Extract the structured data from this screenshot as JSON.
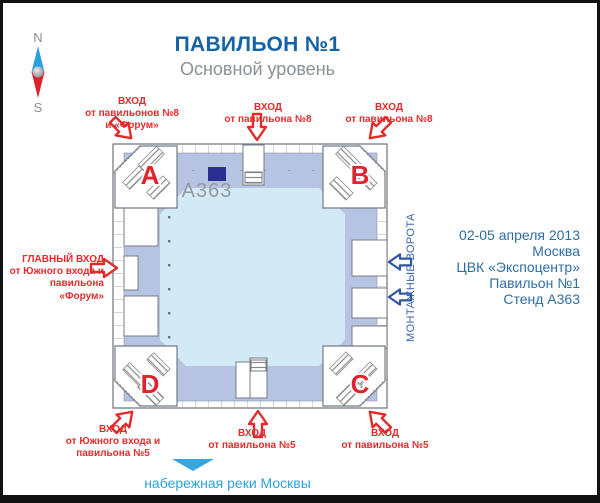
{
  "header": {
    "title": "ПАВИЛЬОН №1",
    "subtitle": "Основной уровень"
  },
  "compass": {
    "north": "N",
    "south": "S"
  },
  "plan": {
    "corners": {
      "a": "A",
      "b": "B",
      "c": "C",
      "d": "D"
    },
    "stand_label": "А363"
  },
  "entrances": {
    "top_left": {
      "l1": "ВХОД",
      "l2": "от павильонов №8",
      "l3": "и «Форум»"
    },
    "top_middle": {
      "l1": "ВХОД",
      "l2": "от павильона №8"
    },
    "top_right": {
      "l1": "ВХОД",
      "l2": "от павильона №8"
    },
    "main_left": {
      "l1": "ГЛАВНЫЙ ВХОД",
      "l2": "от Южного входа и",
      "l3": "павильона",
      "l4": "«Форум»"
    },
    "bottom_left": {
      "l1": "ВХОД",
      "l2": "от Южного входа и",
      "l3": "павильона №5"
    },
    "bottom_middle": {
      "l1": "ВХОД",
      "l2": "от павильона №5"
    },
    "bottom_right": {
      "l1": "ВХОД",
      "l2": "от павильона №5"
    }
  },
  "gates": {
    "label": "МОНТАЖНЫЕ ВОРОТА"
  },
  "event_info": {
    "line1": "02-05 апреля 2013",
    "line2": "Москва",
    "line3": "ЦВК «Экспоцентр»",
    "line4": "Павильон №1",
    "line5": "Стенд А363"
  },
  "river": {
    "label": "набережная реки Москвы"
  },
  "icons": {
    "compass": "compass-rose-icon",
    "entrance_arrow": "red-outline-arrow-icon",
    "gate_arrow": "blue-outline-arrow-icon",
    "river_arrow": "down-triangle-icon"
  },
  "colors": {
    "title_blue": "#1563a5",
    "subtitle_gray": "#8a9095",
    "label_red": "#e32b2b",
    "info_blue": "#2e6da4",
    "gates_blue": "#3a63ad",
    "river_blue": "#29a3dc",
    "band_fill": "#b6c3e2",
    "hall_fill": "#d4e9f6",
    "stand_navy": "#2b2f8f"
  }
}
